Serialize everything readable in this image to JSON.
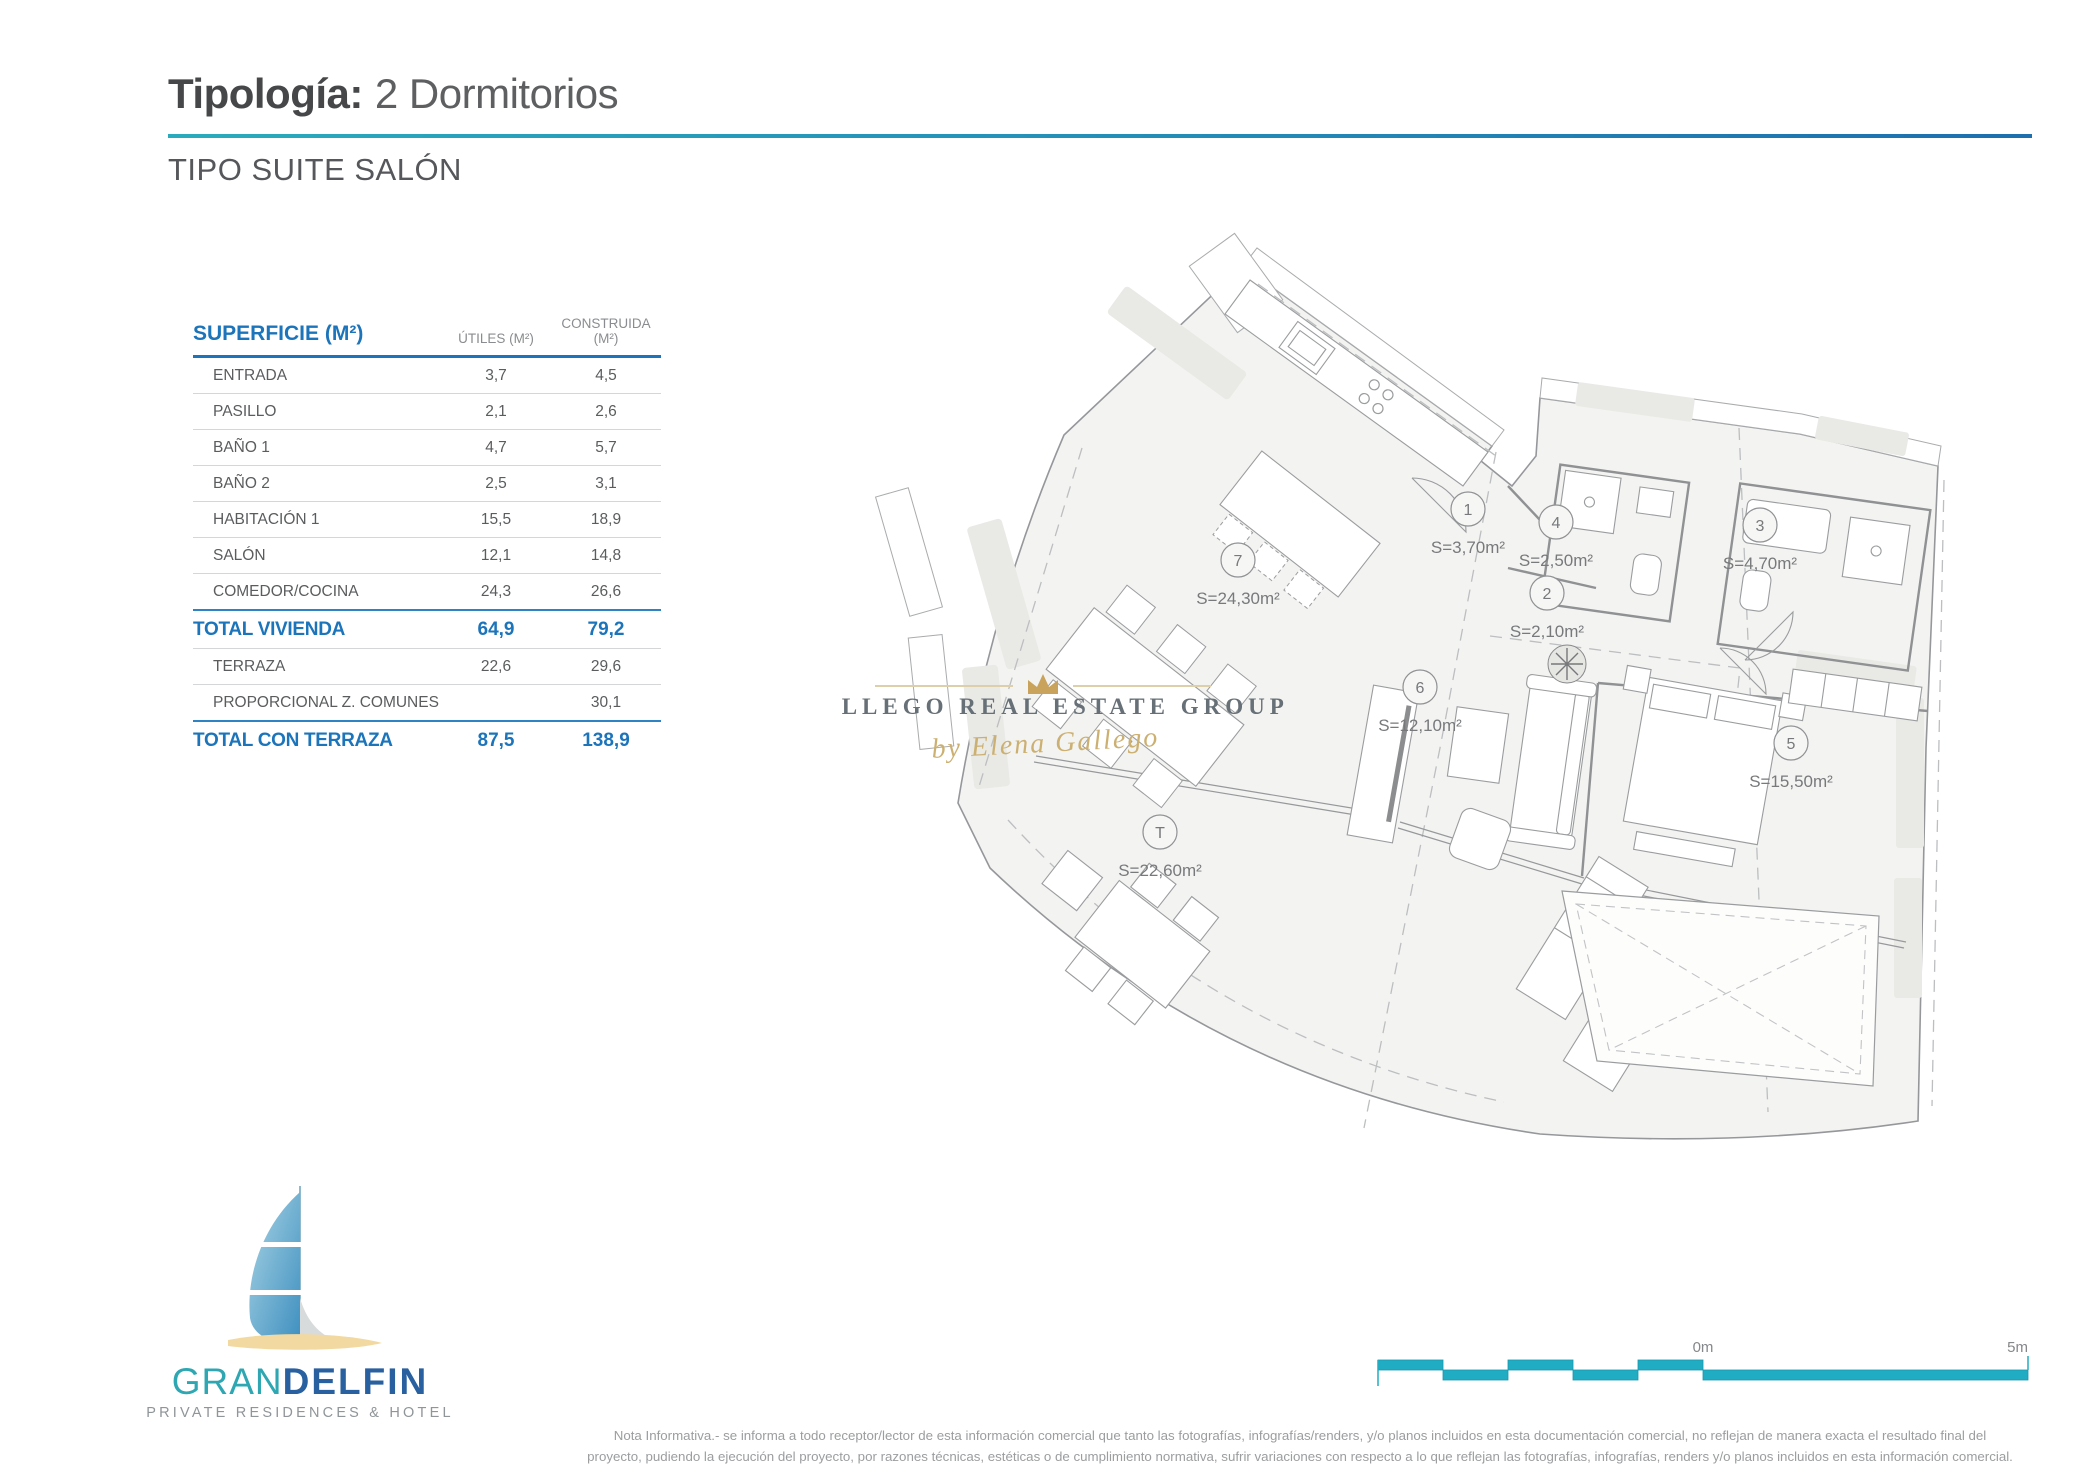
{
  "header": {
    "title_bold": "Tipología:",
    "title_rest": "2 Dormitorios",
    "subtitle": "TIPO SUITE SALÓN"
  },
  "colors": {
    "accent_teal": "#25aec6",
    "accent_blue": "#1c74ba",
    "rule_gradient_start": "#2aabbd",
    "rule_gradient_end": "#1d6fae",
    "gold": "#c9a35c",
    "logo_teal": "#2ea7b2",
    "logo_navy": "#29609f",
    "sand": "#f2d9a2"
  },
  "table": {
    "header": {
      "col1": "SUPERFICIE (M²)",
      "col2": "ÚTILES (M²)",
      "col3": "CONSTRUIDA (M²)"
    },
    "rows": [
      {
        "name": "ENTRADA",
        "utiles": "3,7",
        "construida": "4,5",
        "type": "item"
      },
      {
        "name": "PASILLO",
        "utiles": "2,1",
        "construida": "2,6",
        "type": "item"
      },
      {
        "name": "BAÑO 1",
        "utiles": "4,7",
        "construida": "5,7",
        "type": "item"
      },
      {
        "name": "BAÑO 2",
        "utiles": "2,5",
        "construida": "3,1",
        "type": "item"
      },
      {
        "name": "HABITACIÓN 1",
        "utiles": "15,5",
        "construida": "18,9",
        "type": "item"
      },
      {
        "name": "SALÓN",
        "utiles": "12,1",
        "construida": "14,8",
        "type": "item"
      },
      {
        "name": "COMEDOR/COCINA",
        "utiles": "24,3",
        "construida": "26,6",
        "type": "item"
      },
      {
        "name": "TOTAL VIVIENDA",
        "utiles": "64,9",
        "construida": "79,2",
        "type": "total"
      },
      {
        "name": "TERRAZA",
        "utiles": "22,6",
        "construida": "29,6",
        "type": "item"
      },
      {
        "name": "PROPORCIONAL Z. COMUNES",
        "utiles": "",
        "construida": "30,1",
        "type": "item"
      },
      {
        "name": "TOTAL CON TERRAZA",
        "utiles": "87,5",
        "construida": "138,9",
        "type": "total"
      }
    ]
  },
  "floorplan": {
    "rooms": [
      {
        "id": "1",
        "area": "S=3,70m²"
      },
      {
        "id": "4",
        "area": "S=2,50m²"
      },
      {
        "id": "3",
        "area": "S=4,70m²"
      },
      {
        "id": "2",
        "area": "S=2,10m²"
      },
      {
        "id": "7",
        "area": "S=24,30m²"
      },
      {
        "id": "6",
        "area": "S=12,10m²"
      },
      {
        "id": "5",
        "area": "S=15,50m²"
      },
      {
        "id": "T",
        "area": "S=22,60m²"
      }
    ],
    "watermark": {
      "line1": "GALLEGO REAL ESTATE GROUP",
      "line2": "by Elena Gallego"
    }
  },
  "logo": {
    "name_part1": "GRAN",
    "name_part2": "DELFIN",
    "tagline": "PRIVATE RESIDENCES & HOTEL"
  },
  "scalebar": {
    "start_label": "0m",
    "end_label": "5m"
  },
  "footer": {
    "line1": "Nota Informativa.- se informa a todo receptor/lector de esta información comercial que tanto las fotografías, infografías/renders, y/o planos incluidos en esta documentación comercial, no reflejan de manera exacta el resultado final del",
    "line2": "proyecto, pudiendo la ejecución del proyecto, por razones técnicas, estéticas o de cumplimiento normativa, sufrir variaciones con respecto a lo que reflejan las fotografías, infografías, renders y/o planos incluidos en esta información comercial."
  }
}
